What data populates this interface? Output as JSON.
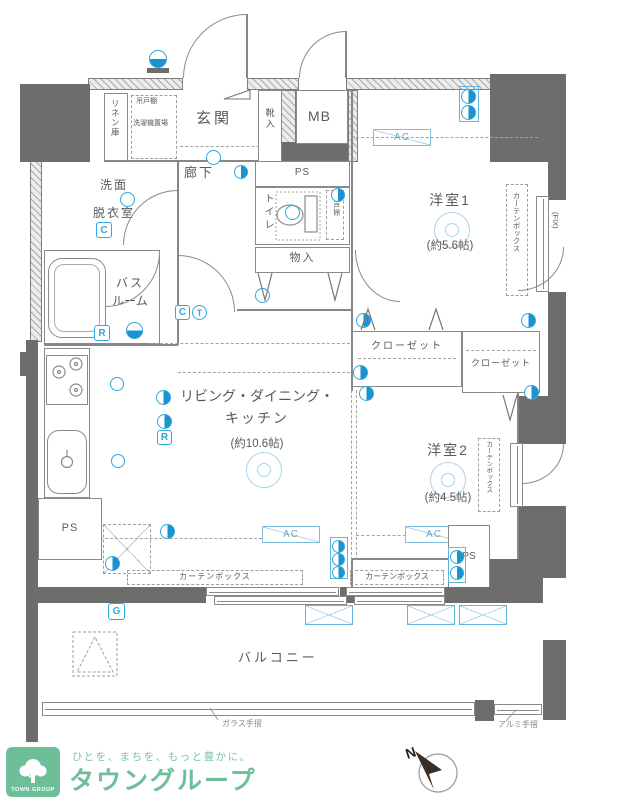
{
  "plan": {
    "labels": {
      "linen": "リネン庫",
      "shelf": "吊戸棚",
      "washer": "洗濯機置場",
      "entrance": "玄関",
      "shoe": "靴入",
      "mb": "MB",
      "corridor": "廊下",
      "ps_top": "PS",
      "toilet": "トイレ",
      "toilet_shelf": "吊戸棚",
      "storage": "物入",
      "washroom_1": "洗面",
      "washroom_2": "脱衣室",
      "bath_1": "バス",
      "bath_2": "ルーム",
      "bedroom1": "洋室1",
      "bedroom1_size": "(約5.6帖)",
      "closet1": "クローゼット",
      "closet2": "クローゼット",
      "ldk_1": "リビング・ダイニング・",
      "ldk_2": "キッチン",
      "ldk_size": "(約10.6帖)",
      "bedroom2": "洋室2",
      "bedroom2_size": "(約4.5帖)",
      "ps_kitchen": "PS",
      "ps_right": "PS",
      "balcony": "バルコニー"
    },
    "fixtures": {
      "curtain_v1": "カーテンボックス",
      "fix_window": "(FIX)",
      "curtain_v2": "カーテンボックス",
      "curtain_h1": "カーテンボックス",
      "curtain_h2": "カーテンボックス",
      "ac1": "AC",
      "ac2": "AC",
      "ac3": "AC",
      "glass_rail": "ガラス手摺",
      "alum_rail": "アルミ手摺"
    },
    "icon_letters": {
      "washroom_outlet": "C",
      "bath_remote": "R",
      "hall_outlet": "C",
      "hall_thermo": "T",
      "kitchen_remote": "R",
      "balcony_gas": "G"
    },
    "compass_label": "N"
  },
  "footer": {
    "tagline": "ひとを、まちを、もっと豊かに。",
    "brand": "タウングループ",
    "badge": "TOWN GROUP"
  },
  "colors": {
    "accent_blue": "#29abe2",
    "brand_green": "#6fbe9a",
    "wall_dark": "#6d6d6d",
    "line_gray": "#8a8a8a"
  }
}
